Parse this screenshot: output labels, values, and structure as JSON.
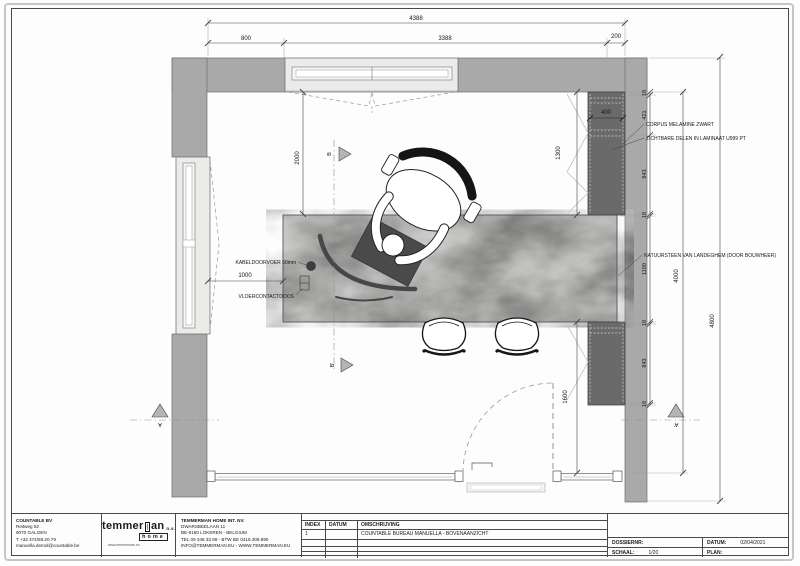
{
  "colors": {
    "wall": "#a9a9a9",
    "cabinet": "#6a6a6a",
    "desk_marble": "#b6b6b4",
    "dark_item": "#4a4a4a",
    "section_marker": "#b5b5b5",
    "window_fill": "#ebebe9"
  },
  "plan": {
    "dims": {
      "top_total": "4388",
      "top_a": "800",
      "top_b": "3388",
      "top_c": "200",
      "v2000": "2000",
      "h1000": "1000",
      "cab_w": "400",
      "cab_h": "1300",
      "low_h": "1600",
      "room_h": "4000",
      "outer_h": "4800",
      "chain": [
        "18",
        "421",
        "843",
        "18",
        "1100",
        "18",
        "843",
        "18"
      ]
    },
    "annotations": {
      "corpus": "CORPUS MELAMINE ZWART",
      "zichtbare": "ZICHTBARE DELEN IN LAMINAAT U999 PT",
      "natuursteen": "NATUURSTEEN VAN LANDEGHEM (DOOR BOUWHEER)",
      "kabel": "KABELDOORVOER 60mm",
      "vloer": "VLOERCONTACTDOOS"
    },
    "sections": {
      "b": "B",
      "b_acc": "B'",
      "a": "A",
      "a_acc": "A'"
    }
  },
  "title_block": {
    "company": {
      "name": "COUNTABLE BV",
      "line1": "Reitweg 52",
      "line2": "9070 GALGEN",
      "line3": "T +32 474/59.20.79",
      "line4": "manuella.demol@countable.be"
    },
    "logo": {
      "part1": "temmer",
      "part2": "an",
      "suffix": "n.v.",
      "home": "home",
      "url": "www.temmerman.eu"
    },
    "firm": {
      "name": "TEMMERMAN HOME INT. NV.",
      "line1": "DWARSBEELAAN 11",
      "line2": "BE-9160 LOKEREN - BELGIUM",
      "line3": "TEL 09 348 33 69 - BTW BE 0416.309.890",
      "line4": "INFO@TEMMERMAN.EU - WWW.TEMMERMAN.EU"
    },
    "table": {
      "h_index": "INDEX",
      "h_datum": "DATUM",
      "h_omschrijving": "OMSCHRIJVING",
      "rows": [
        {
          "index": "1",
          "datum": "",
          "omschrijving": "COUNTABLE BUREAU MANUELLA - BOVENAANZICHT"
        }
      ]
    },
    "meta": {
      "dossier_label": "DOSSIERNR:",
      "dossier_value": "",
      "datum_label": "DATUM:",
      "datum_value": "02/04/2021",
      "schaal_label": "SCHAAL:",
      "schaal_value": "1/20",
      "plan_label": "PLAN:",
      "plan_value": ""
    }
  }
}
